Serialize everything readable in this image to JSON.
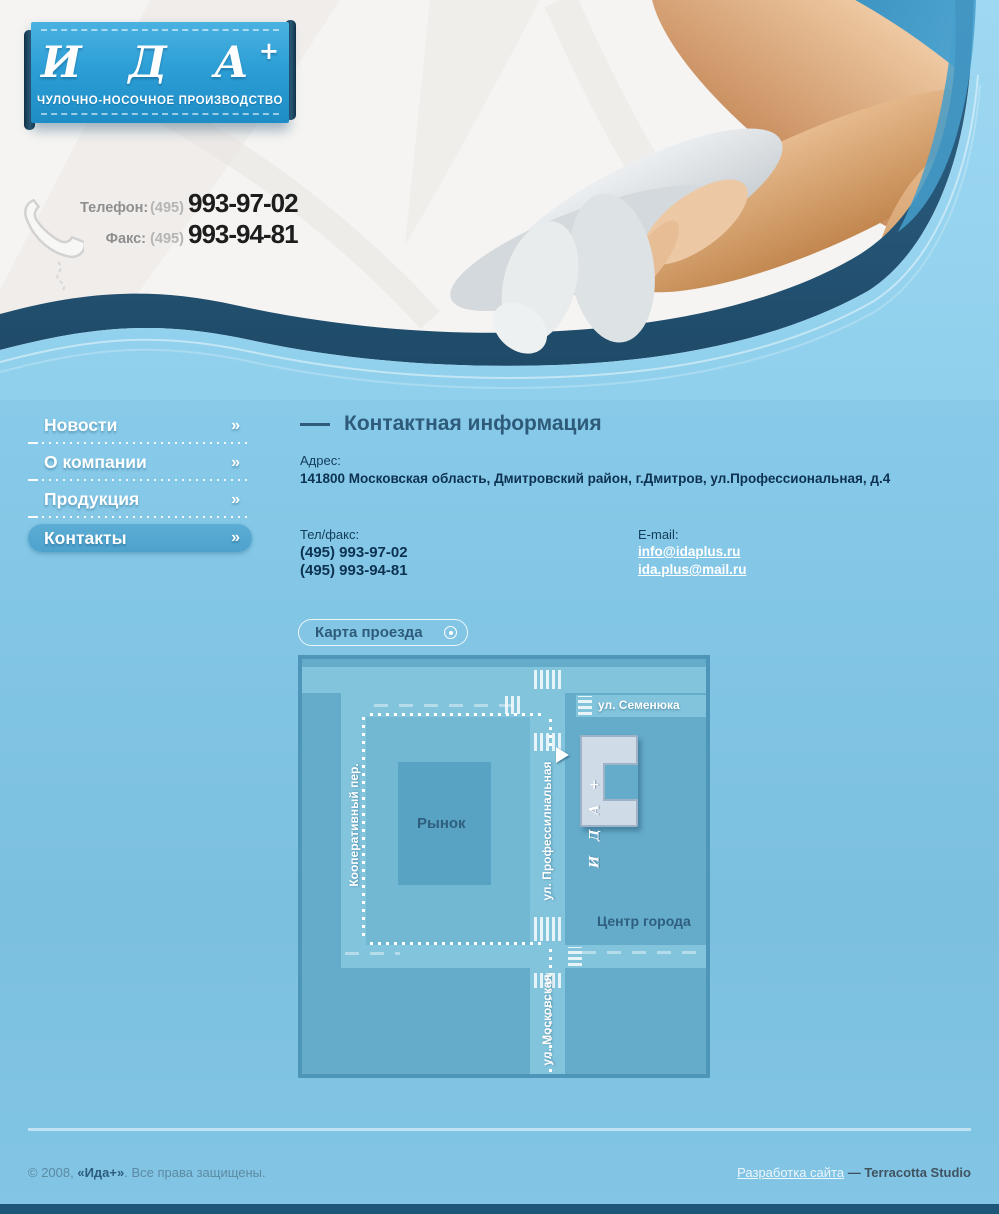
{
  "header": {
    "logo": {
      "text": "И Д А",
      "plus": "+",
      "subtitle": "ЧУЛОЧНО-НОСОЧНОЕ ПРОИЗВОДСТВО"
    },
    "phone": {
      "label": "Телефон:",
      "code": "(495)",
      "number": "993-97-02"
    },
    "fax": {
      "label": "Факс:",
      "code": "(495)",
      "number": "993-94-81"
    }
  },
  "nav": {
    "arrow": "»",
    "items": [
      {
        "label": "Новости",
        "active": false
      },
      {
        "label": "О компании",
        "active": false
      },
      {
        "label": "Продукция",
        "active": false
      },
      {
        "label": "Контакты",
        "active": true
      }
    ]
  },
  "content": {
    "heading": "Контактная информация",
    "address_label": "Адрес:",
    "address": "141800 Московская область, Дмитровский район, г.Дмитров, ул.Профессиональная, д.4",
    "telfax_label": "Тел/факс:",
    "phones": [
      "(495) 993-97-02",
      "(495) 993-94-81"
    ],
    "email_label": "E-mail:",
    "emails": [
      "info@idaplus.ru",
      "ida.plus@mail.ru"
    ],
    "map_button": "Карта проезда"
  },
  "map": {
    "streets": {
      "semenyuka": "ул. Семенюка",
      "kooperativny": "Кооперативный пер.",
      "professionalnaya": "ул. Профессилнальная",
      "moskovskaya": "ул. Московская"
    },
    "labels": {
      "rynok": "Рынок",
      "center": "Центр города",
      "building": "И Д А +"
    }
  },
  "footer": {
    "copyright_prefix": "© 2008, ",
    "brand": "«Ида+»",
    "copyright_suffix": ". Все права защищены.",
    "dev_link": "Разработка сайта",
    "dev_sep": " — ",
    "dev_name": "Terracotta Studio"
  },
  "colors": {
    "brand_blue": "#2d9fd6",
    "wave_navy": "#2a5c80",
    "body_blue": "#85c8e7",
    "map_bg": "#64acca",
    "map_road": "#83c4dd",
    "text_dark_blue": "#2e5b7a"
  }
}
